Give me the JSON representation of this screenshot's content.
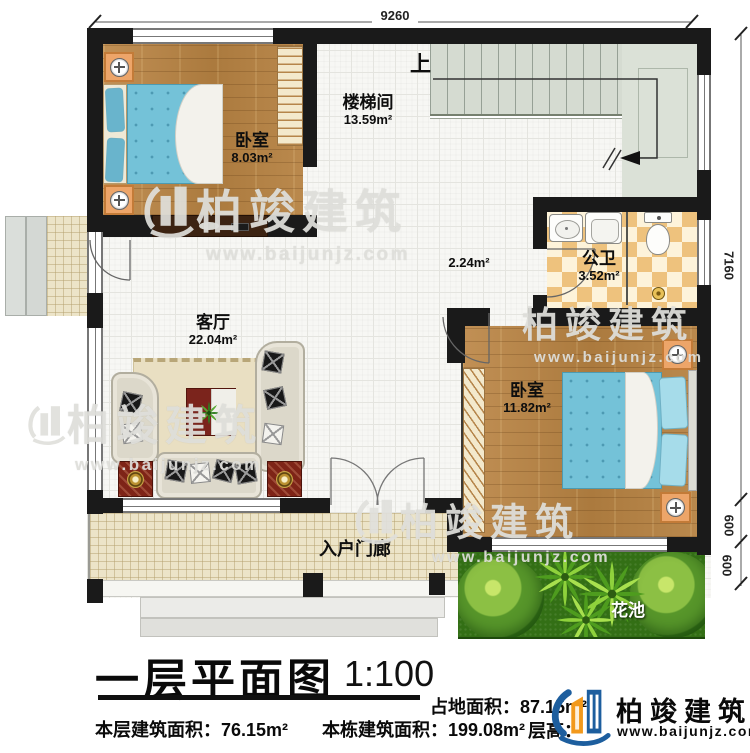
{
  "plan": {
    "dim_width": "9260",
    "dim_right": [
      "7160",
      "600",
      "600"
    ],
    "stairs_up": "上",
    "rooms": {
      "bedroom1": {
        "name": "卧室",
        "area": "8.03m²"
      },
      "stairwell": {
        "name": "楼梯间",
        "area": "13.59m²"
      },
      "bathroom": {
        "name": "公卫",
        "area": "3.52m²"
      },
      "bedroom2": {
        "name": "卧室",
        "area": "11.82m²"
      },
      "living": {
        "name": "客厅",
        "area": "22.04m²"
      },
      "hall": {
        "area": "2.24m²"
      },
      "porch": {
        "name": "入户门廊"
      },
      "flowerbed": {
        "name": "花池"
      }
    }
  },
  "watermark": {
    "brand": "柏竣建筑",
    "url": "www.baijunjz.com"
  },
  "footer": {
    "title": "一层平面图",
    "scale": "1:100",
    "land_area": "占地面积：87.15m²",
    "floor_height": "层高：",
    "floor_area": "本层建筑面积：76.15m²",
    "building_area": "本栋建筑面积：199.08m²",
    "brand": "柏竣建筑",
    "brand_url": "www.baijunjz.com"
  }
}
